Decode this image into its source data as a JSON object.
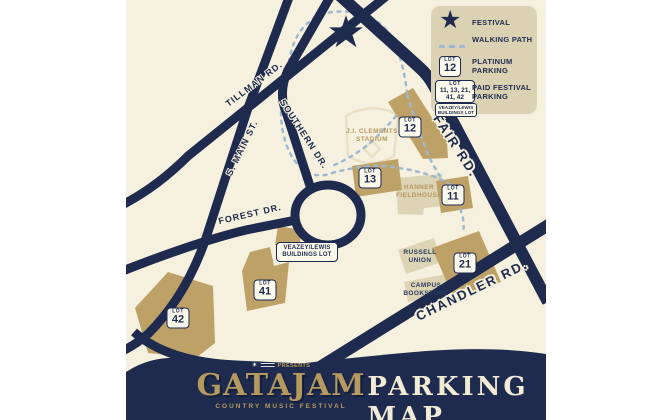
{
  "map": {
    "roads": [
      {
        "name": "tillman-rd",
        "label": "TILLMAN RD."
      },
      {
        "name": "s-main-st",
        "label": "S. MAIN ST."
      },
      {
        "name": "southern-dr",
        "label": "SOUTHERN DR."
      },
      {
        "name": "forest-dr",
        "label": "FOREST DR."
      },
      {
        "name": "fair-rd",
        "label": "FAIR RD."
      },
      {
        "name": "chandler-rd",
        "label": "CHANDLER RD."
      }
    ],
    "lots": [
      {
        "word": "LOT",
        "number": "12"
      },
      {
        "word": "LOT",
        "number": "13"
      },
      {
        "word": "LOT",
        "number": "11"
      },
      {
        "word": "LOT",
        "number": "21"
      },
      {
        "word": "LOT",
        "number": "41"
      },
      {
        "word": "LOT",
        "number": "42"
      }
    ],
    "buildings": [
      {
        "label": "J.I. CLEMENTS STADIUM"
      },
      {
        "label": "HANNER FIELDHOUSE"
      },
      {
        "label": "RUSSELL UNION"
      },
      {
        "label": "CAMPUS BOOKSTORE"
      }
    ],
    "veazey_badge": {
      "line1": "VEAZEY/LEWIS",
      "line2": "BUILDINGS LOT"
    }
  },
  "legend": {
    "festival_label": "FESTIVAL",
    "walking_path_label": "WALKING PATH",
    "platinum_label": "PLATINUM PARKING",
    "platinum_badge": {
      "word": "LOT",
      "number": "12"
    },
    "paid_label": "PAID FESTIVAL PARKING",
    "paid_badge": {
      "word": "LOT",
      "numbers_line1": "11, 13, 21,",
      "numbers_line2": "41, 42"
    },
    "paid_mini_badge": {
      "line1": "VEAZEY/LEWIS",
      "line2": "BUILDINGS LOT"
    }
  },
  "banner": {
    "presents_label": "PRESENTS",
    "festival_name": "GATAJAM",
    "festival_subtitle": "COUNTRY MUSIC FESTIVAL",
    "map_title": "PARKING MAP"
  },
  "icons": {
    "festival_star": "★",
    "presents_logo": "✶"
  },
  "colors": {
    "navy": "#1e2b4e",
    "cream": "#f6f1de",
    "tan_lot": "#bea167",
    "light_building": "#ddd4b6",
    "legend_bg": "#dbd2b4",
    "gold": "#b6995e",
    "walking_path_blue": "#9db8d2"
  }
}
